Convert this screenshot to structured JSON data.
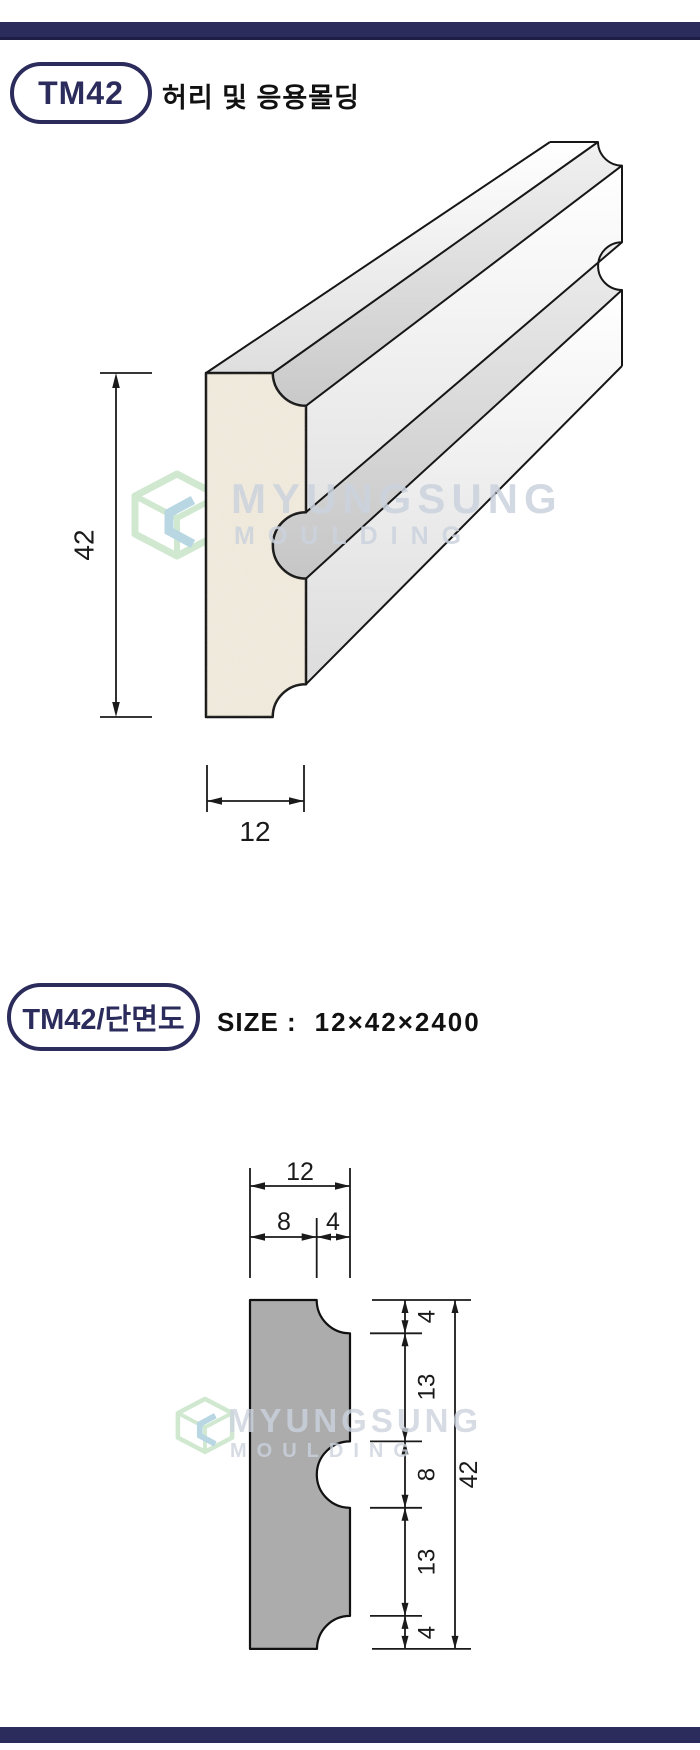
{
  "page": {
    "product_code": "TM42",
    "product_title": "허리 및 응용몰딩",
    "section_label": "TM42/단면도",
    "size_label": "SIZE :",
    "size_value": "12×42×2400"
  },
  "watermark": {
    "line1": "MYUNGSUNG",
    "line2": "MOULDING"
  },
  "colors": {
    "navy_bar": "#2b2b5c",
    "navy_dark": "#1d1d45",
    "cross_section_fill": "#acacac",
    "front_cap_fill": "#efe9dc",
    "watermark_text": "#ccd3de",
    "logo_green": "#abd6ab",
    "logo_teal": "#7fb7cd",
    "line_color": "#1a1a1a"
  },
  "diagram_3d": {
    "height_label": "42",
    "width_label": "12"
  },
  "cross_section": {
    "width_total": "12",
    "width_left": "8",
    "width_right": "4",
    "right_dims": [
      "4",
      "13",
      "8",
      "13",
      "4"
    ],
    "height_total": "42"
  }
}
